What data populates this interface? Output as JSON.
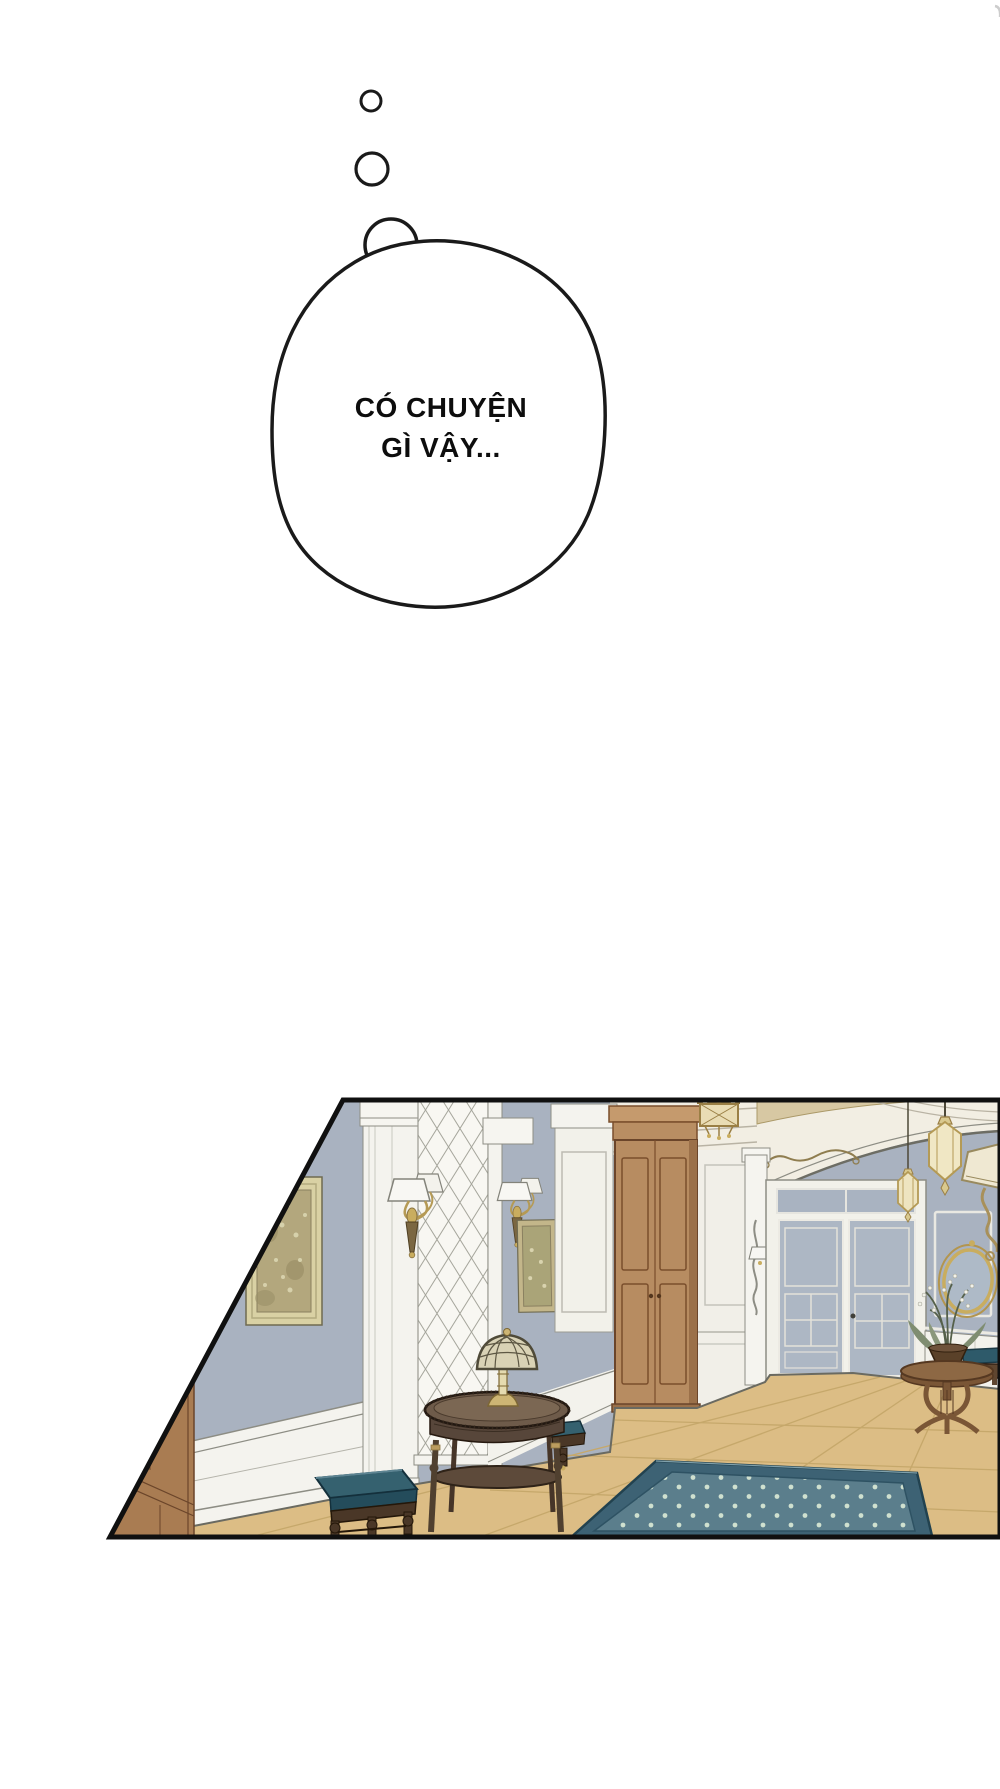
{
  "page": {
    "width": 1000,
    "height": 1789,
    "background_color": "#ffffff"
  },
  "thought_bubble": {
    "lines": [
      "CÓ CHUYỆN",
      "GÌ VẬY..."
    ],
    "text_color": "#0d0d0d",
    "outline_color": "#1a1a1a",
    "fill_color": "#ffffff"
  },
  "panel": {
    "description": "Elegant palace hallway: blue-gray paneled walls with white wainscot, gold-framed paintings, twin-shade brass sconces, diamond-quilted wall panel, tall wooden cabinet, arched cream frieze with scroll ornament, hanging brass lanterns, glazed double doors, oval gold mirror, flower bowl on round pedestal table, teal stools, dark side table with tiffany lamp, parquet floor and dotted teal rug",
    "border_color": "#101010",
    "palette": {
      "wall_blue_gray": "#a9b2c0",
      "trim_white": "#f4f3ee",
      "frieze_cream": "#f2eee3",
      "ceiling_tan": "#d7c8a3",
      "floor_tan": "#dcbd85",
      "floor_line": "#c6a86b",
      "rug_field_teal": "#5b7e8c",
      "rug_border_teal": "#3d6274",
      "rug_dot": "#cfe0cf",
      "cushion_teal": "#35616f",
      "stool_wood": "#4a3727",
      "cabinet_wood": "#b78c61",
      "near_door_wood": "#a97c52",
      "table_wood": "#6e5b4a",
      "brass_gold": "#c9ad5f",
      "picture_frame_gold": "#d9d1a4",
      "painting_sepia": "#b3a77d"
    }
  }
}
